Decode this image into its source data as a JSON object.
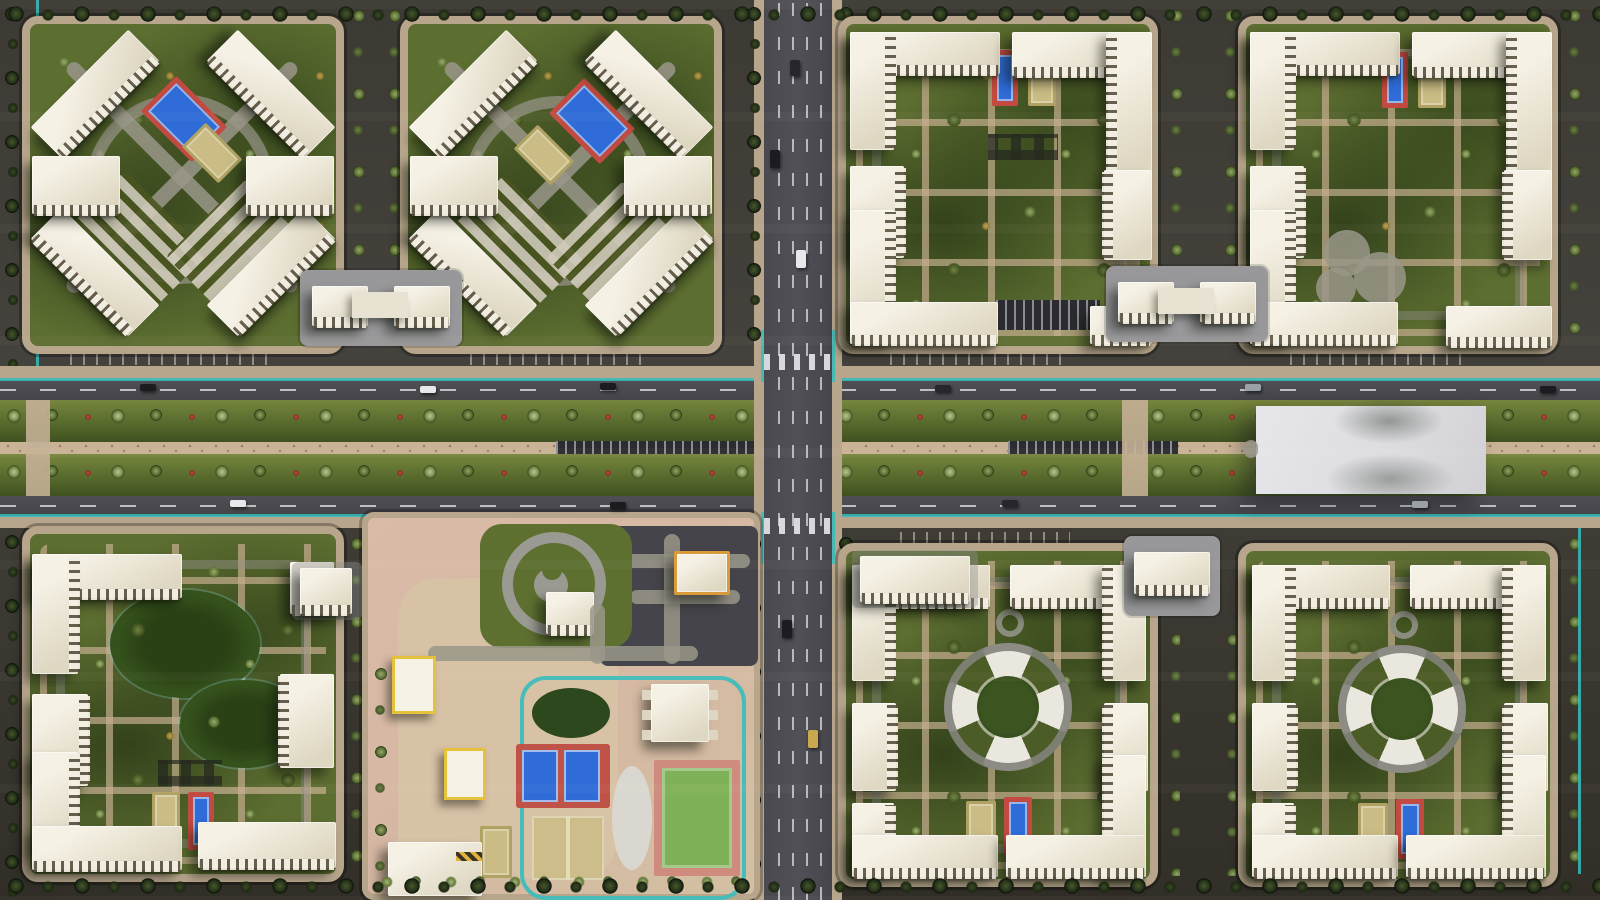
{
  "scene": {
    "kind": "aerial-3d-render",
    "subject": "residential-masterplan-top-down",
    "blocks": [
      {
        "id": "northwest-1",
        "courtyard": "diagonal-paths",
        "features": [
          "tennis-court-blue",
          "court-khaki",
          "striped-plaza",
          "circular-path"
        ]
      },
      {
        "id": "northwest-2",
        "courtyard": "diagonal-paths",
        "features": [
          "tennis-court-blue",
          "court-khaki",
          "striped-plaza",
          "circular-path"
        ]
      },
      {
        "id": "northeast-1",
        "courtyard": "orthogonal-grid",
        "features": [
          "tennis-court-blue",
          "court-khaki",
          "playground-grid",
          "parking-lot"
        ]
      },
      {
        "id": "northeast-2",
        "courtyard": "orthogonal-grid",
        "features": [
          "tennis-court-blue",
          "court-khaki",
          "clover-plaza"
        ]
      },
      {
        "id": "southwest-1",
        "courtyard": "orthogonal-grid",
        "features": [
          "pond-lawns",
          "playground-grid",
          "tennis-court-blue",
          "court-khaki"
        ]
      },
      {
        "id": "south-center-campus",
        "courtyard": "school-kindergarten",
        "features": [
          "teal-running-track",
          "tennis-courts-blue-pair",
          "khaki-courts-pair",
          "green-field",
          "oval-lawn",
          "yin-yang-park",
          "kindergarten-yellow-trim",
          "orange-trim-school"
        ]
      },
      {
        "id": "southeast-1",
        "courtyard": "circular-compass-plaza",
        "features": [
          "compass-plaza",
          "mini-ring",
          "tennis-court-blue",
          "court-khaki"
        ]
      },
      {
        "id": "southeast-2",
        "courtyard": "circular-compass-plaza",
        "features": [
          "compass-plaza",
          "mini-ring",
          "tennis-court-blue",
          "court-khaki"
        ]
      }
    ],
    "boulevard": {
      "orientation": "horizontal",
      "roadways": 2,
      "green_medians": 2,
      "median_tree_rows": 2,
      "red_shrubs": true,
      "central_gravel_path": true,
      "parked_vehicle_rows": 2,
      "white_plaza_slab": true
    },
    "main_road": {
      "orientation": "vertical",
      "lane_markings": "dashed-white",
      "zebra_crossings": 2,
      "edge_accent": "teal-cycle-lane"
    },
    "schools_between_blocks": 3,
    "counts": {
      "tennis_courts_blue": 9,
      "khaki_courts": 8,
      "green_fields": 1,
      "circular_plazas": 2,
      "residential_blocks": 7
    }
  },
  "palette": {
    "asphalt": "#45444a",
    "asphaltDark": "#332f2b",
    "sidewalk": "#b7a68c",
    "gravel": "#c9b295",
    "plazaPink": "#d6b7a3",
    "sand": "#d9c6a6",
    "lawn": "#5d6e31",
    "lawnDark": "#37481c",
    "treeSage": "#b9c893",
    "treeDark": "#26331a",
    "bushRed": "#b44a3c",
    "roofWhite": "#f2eee2",
    "roofShade": "#ddd6c2",
    "windowDark": "#5a5242",
    "courtBlue": "#2f6cd8",
    "courtRed": "#c34a40",
    "courtKhaki": "#cabc84",
    "fieldGreen": "#7fb258",
    "fieldBorder": "#cf8b7e",
    "teal": "#35bdbd",
    "slabWhite": "#e2e2e6",
    "pathGray": "#98989a",
    "laneWhite": "#d8d8da",
    "schoolOrange": "#d99a3a",
    "kinderYellow": "#e4c23c"
  }
}
